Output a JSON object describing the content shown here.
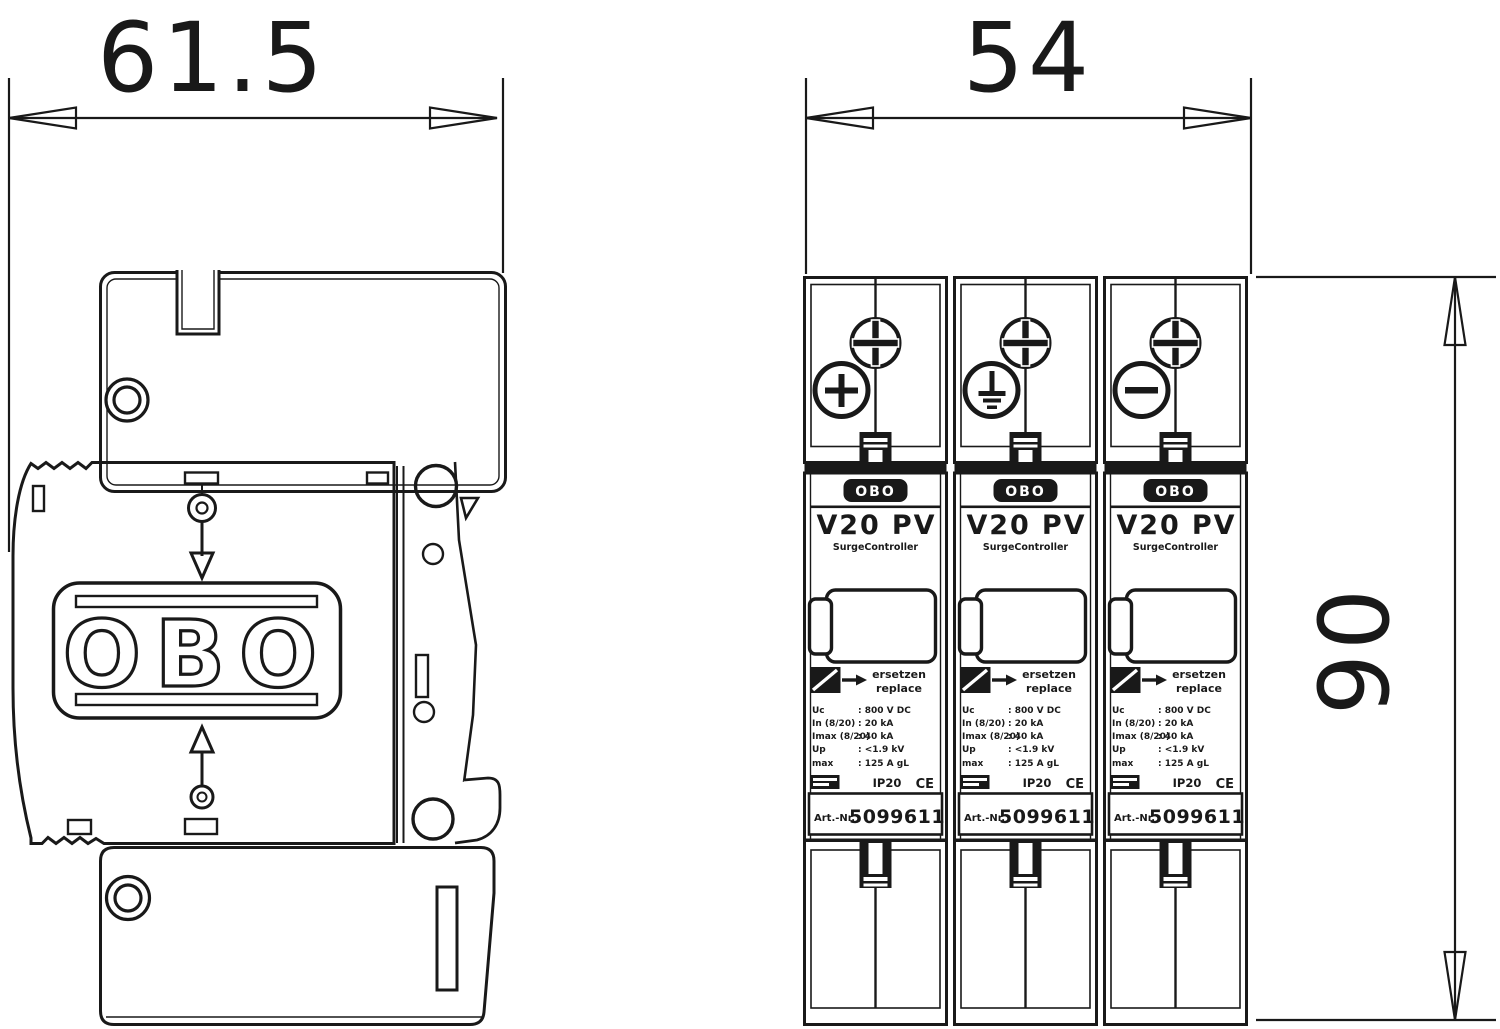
{
  "dimensions": {
    "side_width_mm": "61.5",
    "front_width_mm": "54",
    "front_height_mm": "90"
  },
  "side_view": {
    "logo_text": "OBO"
  },
  "modules": [
    {
      "brand": "OBO",
      "model": "V20 PV",
      "subtitle": "SurgeController",
      "replace_de": "ersetzen",
      "replace_en": "replace",
      "terminal_symbol": "+",
      "specs": [
        {
          "label": "Uc",
          "value": ": 800 V DC"
        },
        {
          "label": "In (8/20)",
          "value": ": 20 kA"
        },
        {
          "label": "Imax (8/20)",
          "value": ": 40 kA"
        },
        {
          "label": "Up",
          "value": ": <1.9 kV"
        },
        {
          "label": "max",
          "value": ": 125 A gL"
        }
      ],
      "ip_rating": "IP20",
      "ce_mark": "CE",
      "art_label": "Art.-Nr.",
      "art_number": "5099611"
    },
    {
      "brand": "OBO",
      "model": "V20 PV",
      "subtitle": "SurgeController",
      "replace_de": "ersetzen",
      "replace_en": "replace",
      "terminal_symbol": "earth",
      "specs": [
        {
          "label": "Uc",
          "value": ": 800 V DC"
        },
        {
          "label": "In (8/20)",
          "value": ": 20 kA"
        },
        {
          "label": "Imax (8/20)",
          "value": ": 40 kA"
        },
        {
          "label": "Up",
          "value": ": <1.9 kV"
        },
        {
          "label": "max",
          "value": ": 125 A gL"
        }
      ],
      "ip_rating": "IP20",
      "ce_mark": "CE",
      "art_label": "Art.-Nr.",
      "art_number": "5099611"
    },
    {
      "brand": "OBO",
      "model": "V20 PV",
      "subtitle": "SurgeController",
      "replace_de": "ersetzen",
      "replace_en": "replace",
      "terminal_symbol": "−",
      "specs": [
        {
          "label": "Uc",
          "value": ": 800 V DC"
        },
        {
          "label": "In (8/20)",
          "value": ": 20 kA"
        },
        {
          "label": "Imax (8/20)",
          "value": ": 40 kA"
        },
        {
          "label": "Up",
          "value": ": <1.9 kV"
        },
        {
          "label": "max",
          "value": ": 125 A gL"
        }
      ],
      "ip_rating": "IP20",
      "ce_mark": "CE",
      "art_label": "Art.-Nr.",
      "art_number": "5099611"
    }
  ]
}
